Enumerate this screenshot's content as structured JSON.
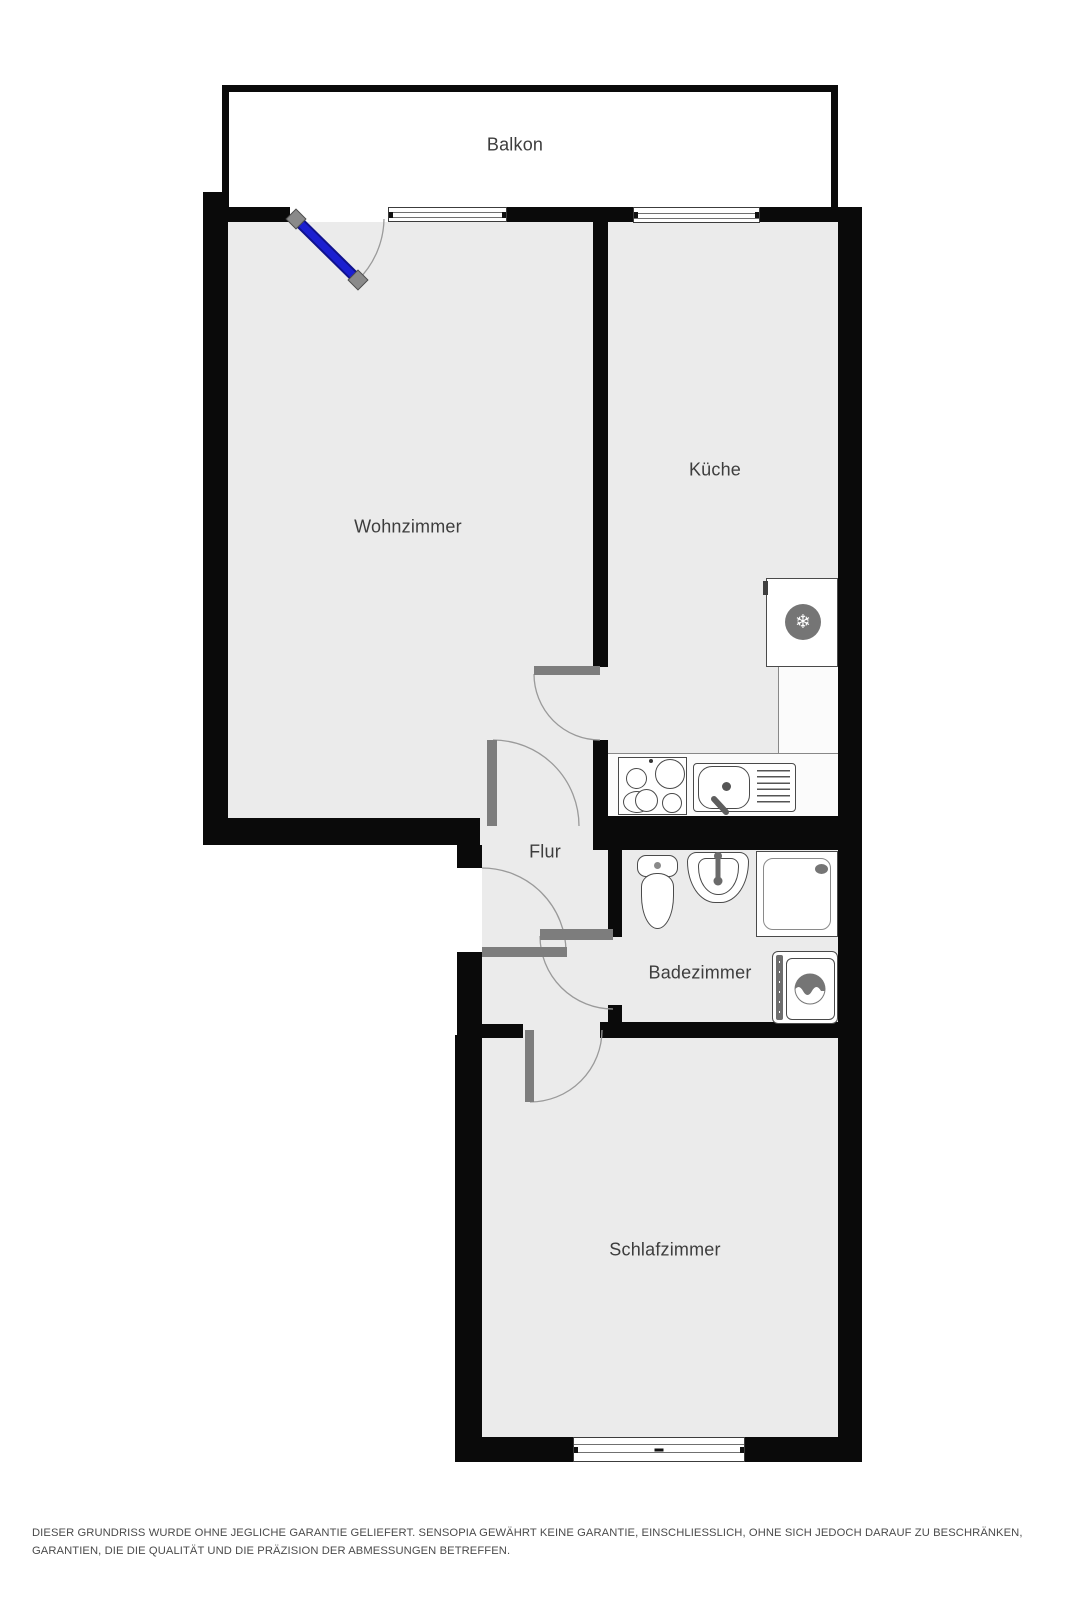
{
  "rooms": {
    "balkon": {
      "label": "Balkon"
    },
    "wohnzimmer": {
      "label": "Wohnzimmer"
    },
    "kueche": {
      "label": "Küche"
    },
    "flur": {
      "label": "Flur"
    },
    "badezimmer": {
      "label": "Badezimmer"
    },
    "schlafzimmer": {
      "label": "Schlafzimmer"
    }
  },
  "icons": {
    "snowflake": "❄"
  },
  "colors": {
    "wall": "#0a0a0a",
    "floor": "#ebebeb",
    "door_leaf": "#7d7d7d",
    "balcony_door_blue": "#1b1fd0",
    "counter": "#fbfbfb",
    "label_text": "#3d3d3d",
    "fixture_outline": "#4a4a4a"
  },
  "disclaimer": "DIESER GRUNDRISS WURDE OHNE JEGLICHE GARANTIE GELIEFERT. SENSOPIA GEWÄHRT KEINE GARANTIE, EINSCHLIESSLICH, OHNE SICH JEDOCH DARAUF ZU BESCHRÄNKEN, GARANTIEN, DIE DIE QUALITÄT UND DIE PRÄZISION DER ABMESSUNGEN BETREFFEN."
}
